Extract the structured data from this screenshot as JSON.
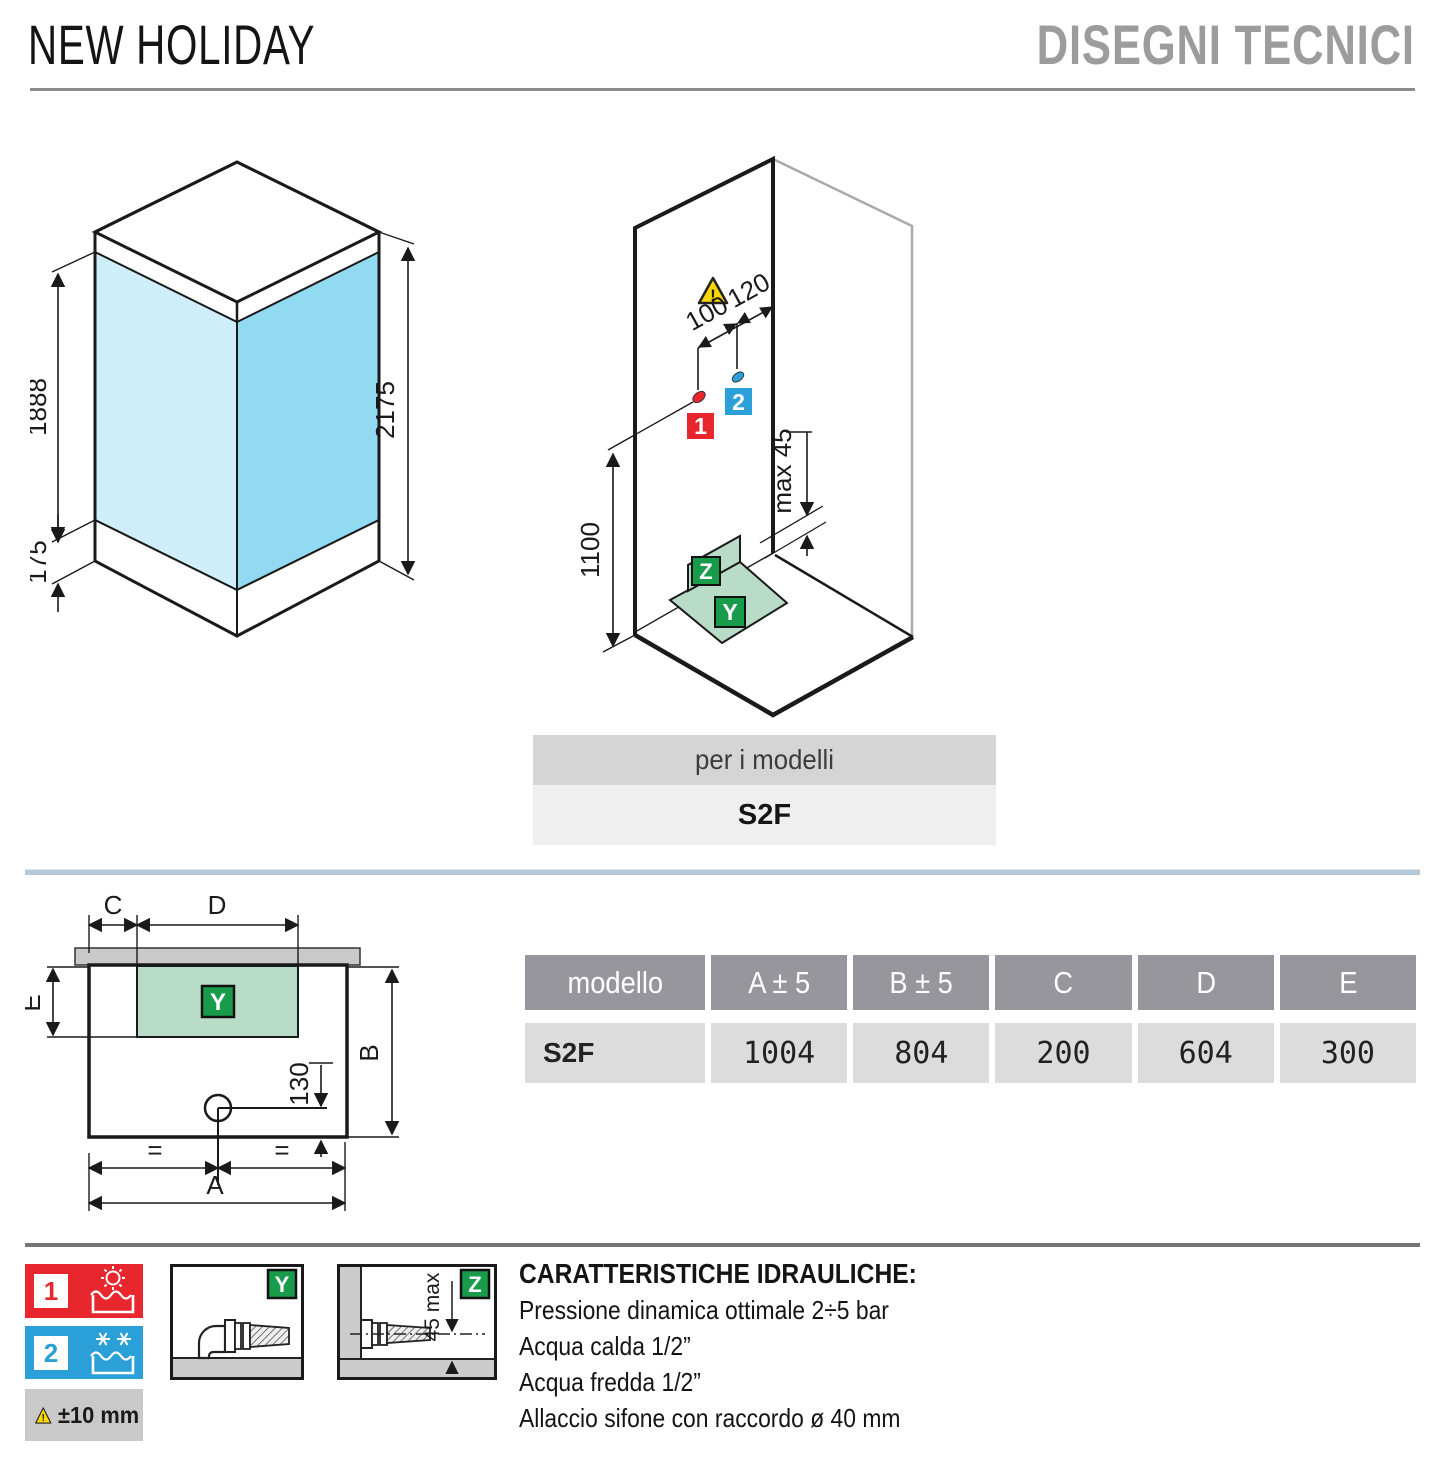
{
  "page": {
    "title_left": "NEW HOLIDAY",
    "title_right": "DISEGNI TECNICI"
  },
  "iso_front": {
    "dim_glass_height": "1888",
    "dim_tray_height": "175",
    "dim_total_height": "2175"
  },
  "iso_install": {
    "dim_hot_offset": "100",
    "dim_cold_offset": "120",
    "dim_height": "1100",
    "dim_max_gap": "max 45",
    "hot_label": "1",
    "cold_label": "2",
    "y_label": "Y",
    "z_label": "Z"
  },
  "models_bar": {
    "header": "per i modelli",
    "model": "S2F"
  },
  "plan": {
    "dim_c": "C",
    "dim_d": "D",
    "dim_e": "E",
    "dim_b": "B",
    "dim_a": "A",
    "dim_drain": "130",
    "equal_left": "=",
    "equal_right": "=",
    "y_label": "Y"
  },
  "table": {
    "headers": [
      "modello",
      "A ± 5",
      "B ± 5",
      "C",
      "D",
      "E"
    ],
    "rows": [
      [
        "S2F",
        "1004",
        "804",
        "200",
        "604",
        "300"
      ]
    ]
  },
  "legend": {
    "hot_number": "1",
    "cold_number": "2",
    "tolerance": "±10 mm",
    "frame_y_label": "Y",
    "frame_z_label": "Z",
    "frame_z_dim": "45 max"
  },
  "hydraulics": {
    "title": "CARATTERISTICHE IDRAULICHE:",
    "lines": [
      "Pressione dinamica ottimale 2÷5 bar",
      "Acqua calda 1/2”",
      "Acqua fredda 1/2”",
      "Allaccio sifone con raccordo ø 40 mm"
    ]
  },
  "colors": {
    "hot_red": "#e8262d",
    "cold_blue": "#2b9fd8",
    "badge_green": "#189c4b",
    "area_green": "#b8dcc8",
    "glass_light": "#cfeefb",
    "glass_shade": "#92d9f2",
    "warning_yellow": "#f8d800",
    "divider_blue_gray": "#b5c8d6",
    "divider_gray": "#767676",
    "table_header_gray": "#96969c",
    "table_row_gray": "#dcdcdc",
    "bar_gray": "#d5d5d5",
    "bar_light": "#efeff0",
    "wall_gray": "#c9c9c9"
  }
}
